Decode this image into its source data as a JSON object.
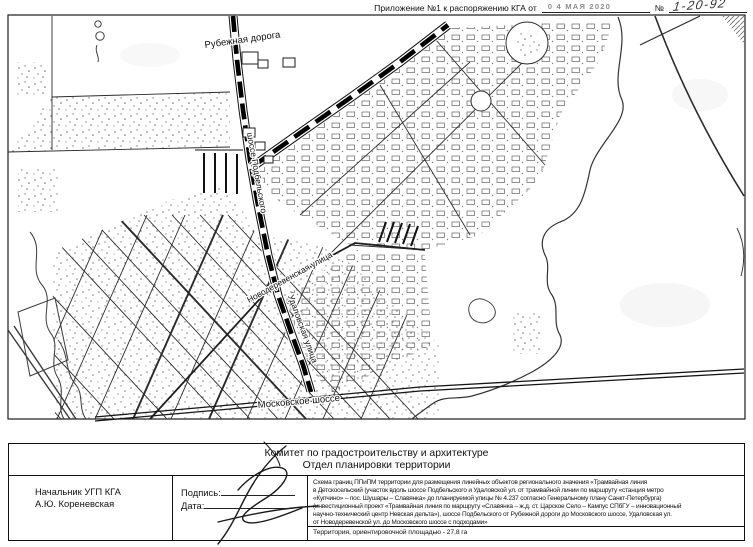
{
  "header": {
    "annex_label": "Приложение №1 к распоряжению КГА от",
    "stamp_date": "0 4  МАЯ  2020",
    "number_sign": "№",
    "number_value": "1-20-92"
  },
  "map": {
    "labels": {
      "rubezhnaya": "Рубежная дорога",
      "podbelskogo": "шоссе Подбельского",
      "novoderevenskaya": "Новодеревенская улица",
      "udalovskaya": "Удаловская улица",
      "moskovskoe": "Московское шоссе"
    }
  },
  "titleblock": {
    "org_line1": "Комитет по градостроительству и архитектуре",
    "org_line2": "Отдел планировки территории",
    "official_position": "Начальник УГП КГА",
    "official_name": "А.Ю. Кореневская",
    "signature_label": "Подпись:",
    "date_label": "Дата:",
    "description_lines": [
      "Схема границ ППиПМ территории для размещения линейных объектов регионального значения «Трамвайная линия",
      "в Детскосельский (участок вдоль шоссе Подбельского и Удаловской ул. от трамвайной линии по маршруту «станция метро",
      "«Купчино» – пос. Шушары – Славянка» до планируемой улицы № 4.237 согласно Генеральному плану Санкт-Петербурга)",
      "(инвестиционный проект «Трамвайная линия по маршруту «Славянка – ж.д. ст. Царское Село – Кампус СПбГУ – инновационный",
      "научно-технический центр Невская дельта»), шоссе Подбельского от Рубежной дороги до Московского шоссе, Удаловская ул.",
      "от Новодеревенской ул. до Московского шоссе с подходами»"
    ],
    "area_note": "Территория, ориентировочной площадью - 27,8 га"
  }
}
